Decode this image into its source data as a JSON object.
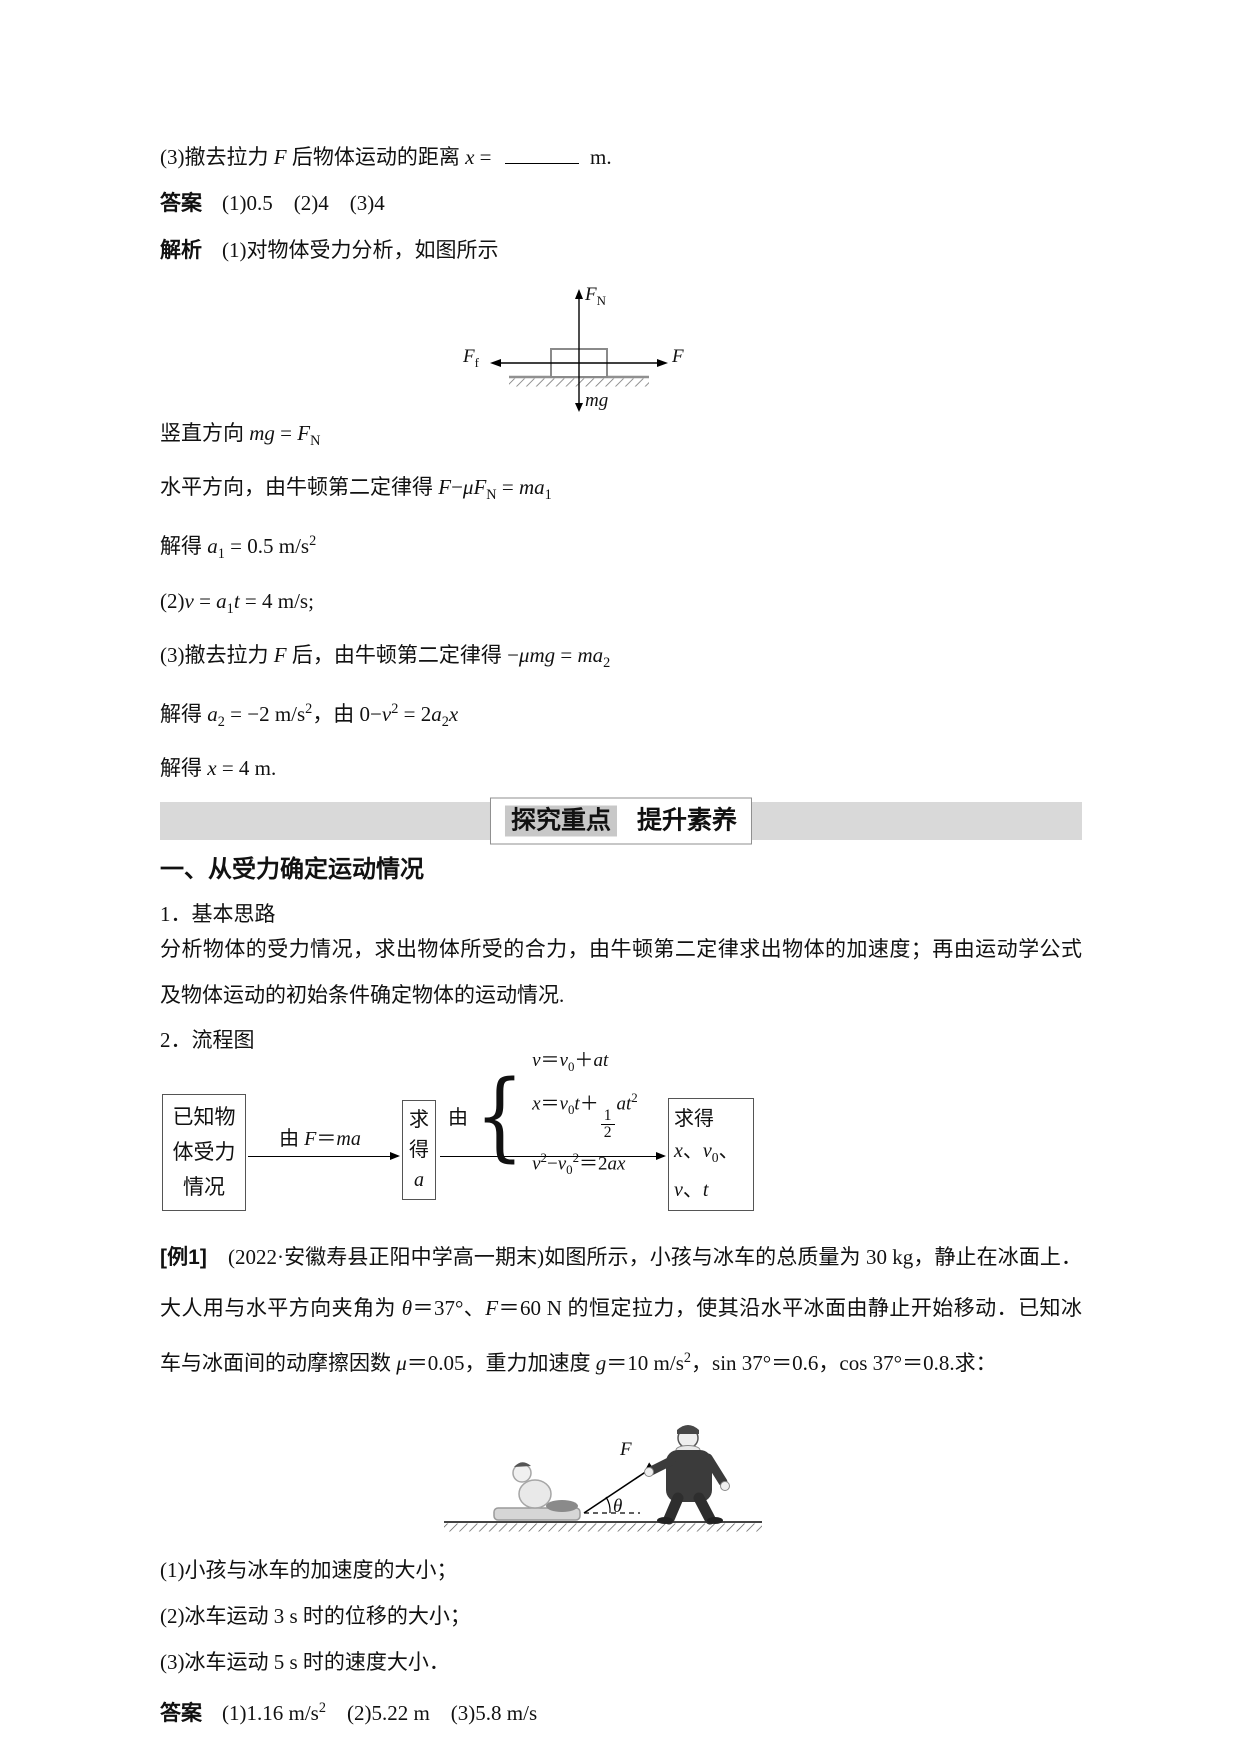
{
  "colors": {
    "banner_bar": "#d9d9d9",
    "banner_left_bg": "#c8c8c8",
    "ink": "#111111",
    "ground_gray": "#888888"
  },
  "solution_top": {
    "q3_line": [
      "(3)撤去拉力 ",
      {
        "i": "F"
      },
      " 后物体运动的距离 ",
      {
        "i": "x"
      },
      " = ",
      {
        "blank": true
      },
      " m."
    ],
    "answer": {
      "label": "答案",
      "values": "(1)0.5　(2)4　(3)4"
    },
    "analysis": {
      "label": "解析",
      "intro": "(1)对物体受力分析，如图所示"
    },
    "fbd_labels": {
      "up": [
        {
          "i": "F"
        },
        {
          "sub": "N"
        }
      ],
      "left": [
        {
          "i": "F"
        },
        {
          "sub": "f"
        }
      ],
      "right": [
        {
          "i": "F"
        }
      ],
      "down": [
        {
          "i": "mg"
        }
      ]
    },
    "steps": [
      [
        "竖直方向 ",
        {
          "i": "mg"
        },
        " = ",
        {
          "i": "F"
        },
        {
          "sub": "N"
        }
      ],
      [
        "水平方向，由牛顿第二定律得 ",
        {
          "i": "F"
        },
        "−",
        {
          "i": "μF"
        },
        {
          "sub": "N"
        },
        " = ",
        {
          "i": "ma"
        },
        {
          "sub": "1"
        }
      ],
      [
        "解得 ",
        {
          "i": "a"
        },
        {
          "sub": "1"
        },
        " = 0.5 m/s",
        {
          "sup": "2"
        }
      ],
      [
        "(2)",
        {
          "i": "v"
        },
        " = ",
        {
          "i": "a"
        },
        {
          "sub": "1"
        },
        {
          "i": "t"
        },
        " = 4 m/s;"
      ],
      [
        "(3)撤去拉力 ",
        {
          "i": "F"
        },
        " 后，由牛顿第二定律得 −",
        {
          "i": "μmg"
        },
        " = ",
        {
          "i": "ma"
        },
        {
          "sub": "2"
        }
      ],
      [
        "解得 ",
        {
          "i": "a"
        },
        {
          "sub": "2"
        },
        " = −2 m/s",
        {
          "sup": "2"
        },
        "，由 0−",
        {
          "i": "v"
        },
        {
          "sup": "2"
        },
        " = 2",
        {
          "i": "a"
        },
        {
          "sub": "2"
        },
        {
          "i": "x"
        }
      ],
      [
        "解得 ",
        {
          "i": "x"
        },
        " = 4 m."
      ]
    ]
  },
  "banner": {
    "left": "探究重点",
    "right": "提升素养"
  },
  "explore": {
    "heading": "一、从受力确定运动情况",
    "item1": "1．基本思路",
    "para1": "分析物体的受力情况，求出物体所受的合力，由牛顿第二定律求出物体的加速度；再由运动学公式及物体运动的初始条件确定物体的运动情况.",
    "item2": "2．流程图",
    "flowchart": {
      "box1": "已知物体受力情况",
      "arrow1_label": [
        "由 ",
        {
          "i": "F"
        },
        "＝",
        {
          "i": "ma"
        }
      ],
      "box2": [
        "求得",
        {
          "br": true
        },
        {
          "i": "a"
        }
      ],
      "arrow2_prefix": "由",
      "brace": "{",
      "equations": [
        [
          {
            "i": "v"
          },
          "＝",
          {
            "i": "v"
          },
          {
            "sub": "0"
          },
          "＋",
          {
            "i": "at"
          }
        ],
        [
          {
            "i": "x"
          },
          "＝",
          {
            "i": "v"
          },
          {
            "sub": "0"
          },
          {
            "i": "t"
          },
          "＋",
          {
            "frac": [
              "1",
              "2"
            ]
          },
          {
            "i": "at"
          },
          {
            "sup": "2"
          }
        ],
        [
          {
            "i": "v"
          },
          {
            "sup": "2"
          },
          "−",
          {
            "i": "v"
          },
          {
            "sub": "0"
          },
          {
            "sup": "2"
          },
          "＝2",
          {
            "i": "ax"
          }
        ]
      ],
      "box3": [
        "求得",
        {
          "br": true
        },
        {
          "i": "x"
        },
        "、",
        {
          "i": "v"
        },
        {
          "sub": "0"
        },
        "、",
        {
          "br": true
        },
        {
          "i": "v"
        },
        "、",
        {
          "i": "t"
        }
      ]
    }
  },
  "example": {
    "paragraph": [
      {
        "b": "[例1]"
      },
      "　(2022·安徽寿县正阳中学高一期末)如图所示，小孩与冰车的总质量为 30 kg，静止在冰面上．大人用与水平方向夹角为 ",
      {
        "i": "θ"
      },
      "＝37°、",
      {
        "i": "F"
      },
      "＝60 N 的恒定拉力，使其沿水平冰面由静止开始移动．已知冰车与冰面间的动摩擦因数 ",
      {
        "i": "μ"
      },
      "＝0.05，重力加速度 ",
      {
        "i": "g"
      },
      "＝10 m/s",
      {
        "sup": "2"
      },
      "，sin 37°＝0.6，cos 37°＝0.8.求："
    ],
    "figure_labels": {
      "force": [
        {
          "i": "F"
        }
      ],
      "angle": [
        {
          "i": "θ"
        }
      ]
    },
    "questions": [
      "(1)小孩与冰车的加速度的大小；",
      "(2)冰车运动 3 s 时的位移的大小；",
      "(3)冰车运动 5 s 时的速度大小．"
    ],
    "answer": {
      "label": "答案",
      "values": [
        "(1)1.16 m/s",
        {
          "sup": "2"
        },
        "　(2)5.22 m　(3)5.8 m/s"
      ]
    }
  }
}
